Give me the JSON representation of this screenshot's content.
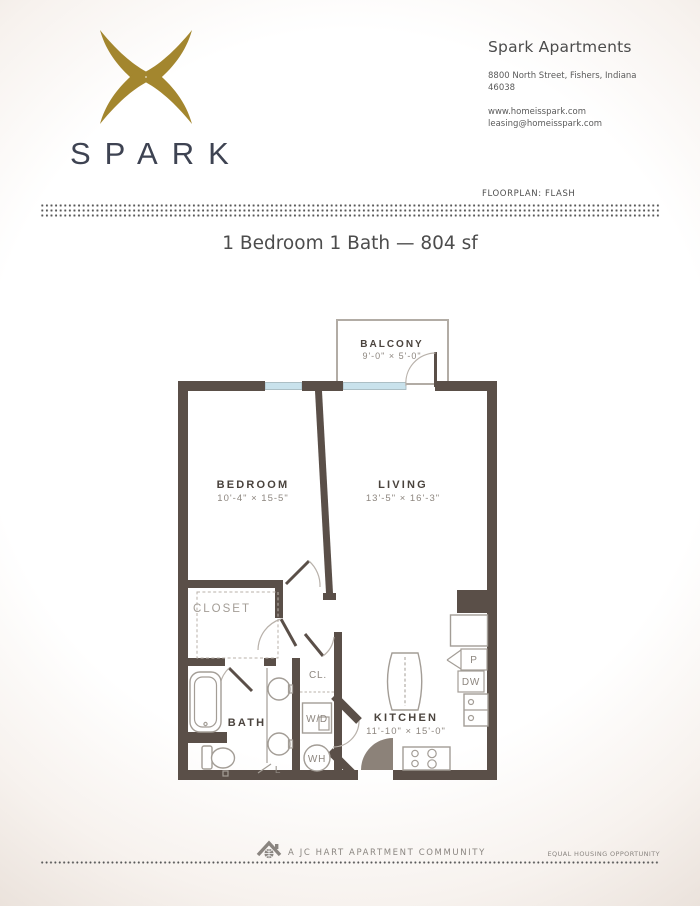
{
  "brand": {
    "logo_text": "SPARK"
  },
  "header": {
    "title": "Spark Apartments",
    "address_line1": "8800 North Street, Fishers, Indiana",
    "address_line2": "46038",
    "website": "www.homeisspark.com",
    "email": "leasing@homeisspark.com",
    "floorplan_label": "FLOORPLAN: FLASH"
  },
  "plan_title": "1 Bedroom 1 Bath — 804 sf",
  "floorplan": {
    "balcony": {
      "name": "BALCONY",
      "dims": "9'-0\" × 5'-0\""
    },
    "bedroom": {
      "name": "BEDROOM",
      "dims": "10'-4\" × 15-5\""
    },
    "living": {
      "name": "LIVING",
      "dims": "13'-5\" × 16'-3\""
    },
    "kitchen": {
      "name": "KITCHEN",
      "dims": "11'-10\" × 15'-0\""
    },
    "labels": {
      "closet": "CLOSET",
      "bath": "BATH",
      "cl": "CL.",
      "washer_dryer": "W/D",
      "water_heater": "WH",
      "linen": "L",
      "pantry": "P",
      "dishwasher": "DW"
    },
    "colors": {
      "wall": "#5a4f48",
      "window": "#c9e2ec",
      "fixture_outline": "#a39d96",
      "room_label": "#4a433d",
      "dim_label": "#8d867f",
      "logo_gold": "#a3862e",
      "logo_navy": "#3e4352"
    }
  },
  "footer": {
    "community": "A JC HART APARTMENT COMMUNITY",
    "equal_housing": "EQUAL HOUSING OPPORTUNITY"
  }
}
